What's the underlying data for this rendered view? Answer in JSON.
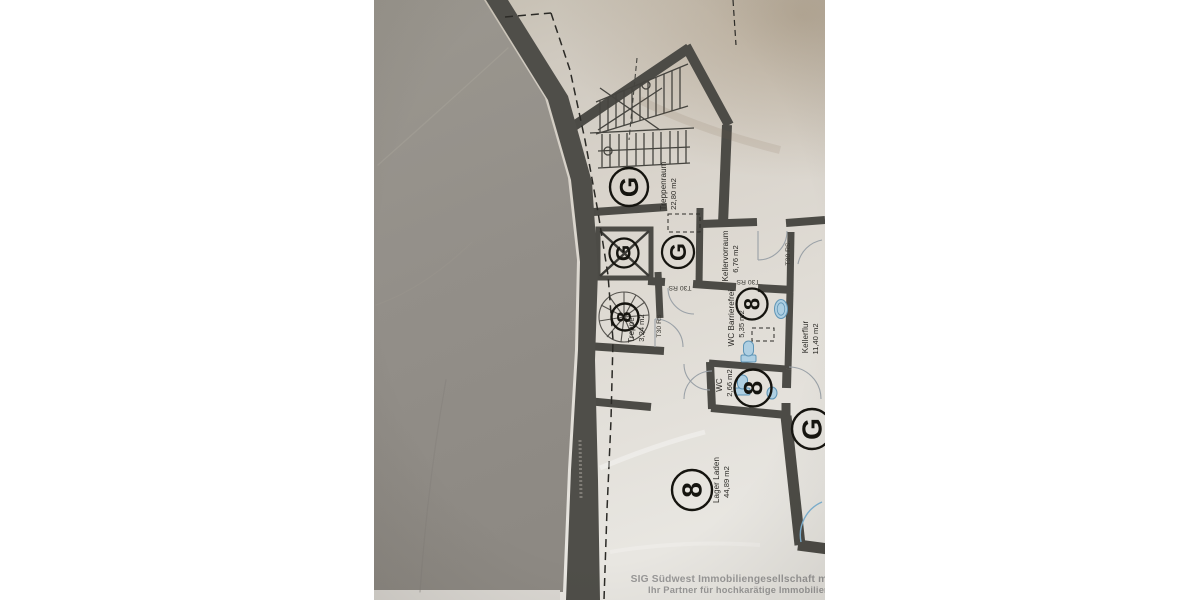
{
  "background": {
    "color": "#ffffff"
  },
  "photo": {
    "description": "tilted photo of a basement floor plan on beige paper, left part covered by grey board",
    "paper_color": "#d7d2ca",
    "cover_color": "#94908a",
    "wall_color": "#4c4b46",
    "fixture_fill": "#aecfe2",
    "fixture_stroke": "#5f95b6",
    "watermark": {
      "line1": "SIG Südwest Immobiliengesellschaft mbH",
      "line2": "Ihr Partner für hochkarätige Immobilien",
      "color": "#8d8d8d"
    },
    "floorplan": {
      "rooms": [
        {
          "name": "Treppenraum",
          "area": "22,80 m2",
          "symbol": "G"
        },
        {
          "name": "Kellervorraum",
          "area": "6,76 m2",
          "symbol": "G"
        },
        {
          "name": "Treppe",
          "area": "3,24 m2",
          "symbol": "8"
        },
        {
          "name": "WC Barrierefrei",
          "area": "5,35 m2",
          "symbol": "8"
        },
        {
          "name": "Kellerflur",
          "area": "11,40 m2",
          "symbol": "G"
        },
        {
          "name": "WC",
          "area": "2,66 m2",
          "symbol": "8"
        },
        {
          "name": "Lager Laden",
          "area": "44,89 m2",
          "symbol": "8"
        }
      ],
      "extra_symbols": [
        {
          "symbol": "G",
          "location": "shaft-box"
        },
        {
          "symbol": "G",
          "location": "kellerflur-south"
        }
      ],
      "door_labels": {
        "treppe_door": "T30 RS",
        "kellervorraum_door": "T30 RS.",
        "lobby_door": "T30 RS",
        "wc_barrierefrei_door": "T30 RS"
      }
    }
  }
}
